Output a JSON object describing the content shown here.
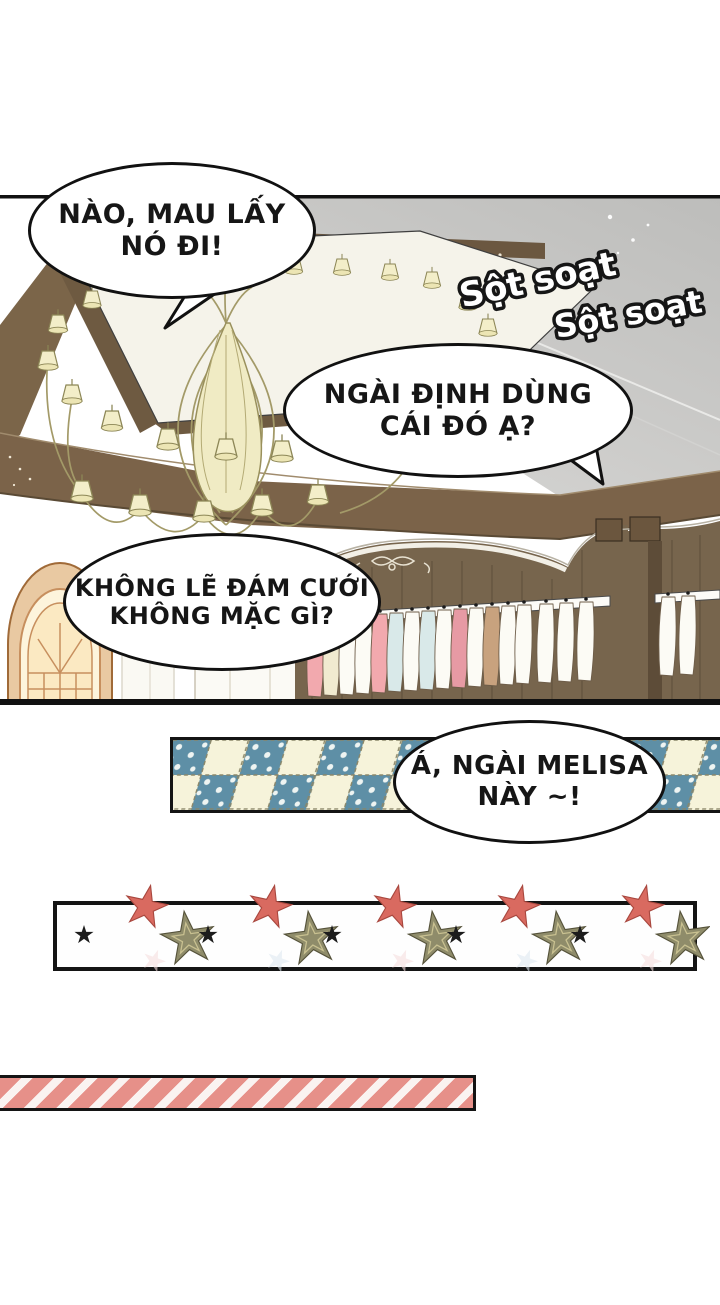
{
  "page": {
    "type": "manhwa-page",
    "background": "#ffffff"
  },
  "bubbles": [
    {
      "name": "bubble-urge",
      "line1": "NÀO, MAU LẤY",
      "line2": "NÓ ĐI!"
    },
    {
      "name": "bubble-question",
      "line1": "NGÀI ĐỊNH DÙNG",
      "line2": "CÁI ĐÓ Ạ?"
    },
    {
      "name": "bubble-wedding",
      "line1": "KHÔNG LẼ ĐÁM CƯỚI",
      "line2": "KHÔNG MẶC GÌ?"
    },
    {
      "name": "bubble-melisa",
      "line1": "Á, NGÀI MELISA",
      "line2": "NÀY ~!"
    }
  ],
  "sfx": [
    {
      "text": "Sột soạt"
    },
    {
      "text": "Sột soạt"
    }
  ],
  "colors": {
    "mirror_gray": "#c6c6c4",
    "wood_brown": "#7b6349",
    "lamp_cream": "#f3eec9",
    "tape_blue": "#5e8fa6",
    "tape_cream": "#f6f3da",
    "stripe_pink": "#e69089",
    "star_red": "#d96a60",
    "star_olive": "#8f8c6a",
    "garment_pink": "#f2a9ae",
    "garment_blue": "#d9e9e9",
    "garment_tan": "#c8a27e"
  }
}
